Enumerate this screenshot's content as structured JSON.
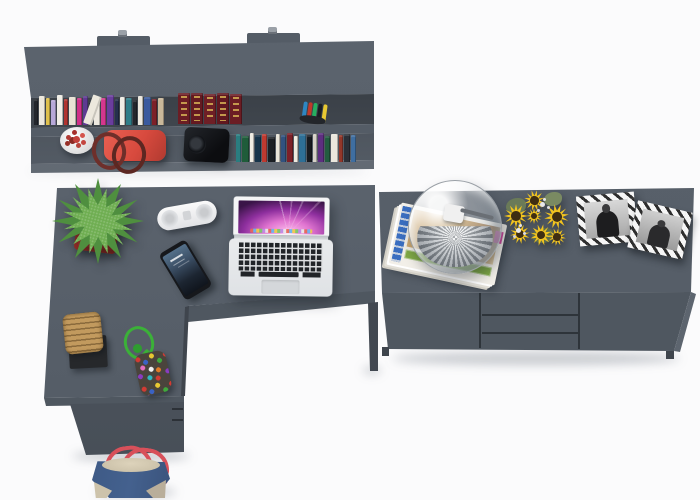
{
  "scene": {
    "kind": "3d-furniture-render-top-view",
    "room": "home office in grey",
    "furniture": [
      {
        "label": "wall shelf with two rows",
        "doors": 0
      },
      {
        "label": "L-shaped desk with drawer pedestal"
      },
      {
        "label": "sideboard",
        "doors": 2,
        "drawers": 3
      }
    ],
    "objects": [
      "books",
      "encyclopedia set",
      "pen cup",
      "white flower pot with red cactus",
      "red handbag",
      "black speaker",
      "potted green plant in red cube pot",
      "white pill speaker",
      "black smartphone",
      "open laptop with purple aurora wallpaper",
      "woven basket on black tray",
      "green cord keychain with beaded pouch",
      "denim tote bag with red straps",
      "glass dome lamp on magazine stack",
      "sunflower bouquet",
      "two black-and-white photo frames"
    ]
  },
  "colors": {
    "background": "#fbfbfc",
    "furniture_top": "#5c646e",
    "furniture_top_dark": "#545c66",
    "furniture_front": "#4f5760",
    "furniture_dark": "#3f454d",
    "shelf_opening": "#565d66",
    "pot_red": "#b5362d",
    "leaf_green": "#4f8f3f",
    "leaf_light": "#6fae52",
    "cord_green": "#3bb138",
    "sunflower_petal": "#f2c41f",
    "sunflower_center": "#3f2e12",
    "bag_denim": "#44618e",
    "bag_strap": "#d8505a",
    "bag_beige": "#cdc3ab",
    "basket_tan": "#c29a5e",
    "encyclopedia_maroon": "#6b1d24",
    "encyclopedia_gold": "#d4af54",
    "laptop_silver": "#e9ebed",
    "laptop_keys": "#212428",
    "wallpaper_pink": "#e074d0",
    "wallpaper_purple": "#8e2f9e",
    "wallpaper_dark": "#3a1448",
    "glass_rim": "#9aa0a6",
    "handbag_red": "#d84a3e",
    "bead_colors": [
      "#d23b33",
      "#3a62c4",
      "#e8c832",
      "#3fa93c",
      "#e46fc0",
      "#f0f0f0",
      "#e07b28",
      "#8a3bc0",
      "#30b8c0"
    ]
  },
  "shelf": {
    "books_upper": [
      {
        "c": "#23262c",
        "w": 4,
        "h": 26
      },
      {
        "c": "#ece7db",
        "w": 6,
        "h": 29
      },
      {
        "c": "#dfc04c",
        "w": 4,
        "h": 27
      },
      {
        "c": "#b7a8d8",
        "w": 5,
        "h": 25
      },
      {
        "c": "#f1eee6",
        "w": 6,
        "h": 30
      },
      {
        "c": "#b03430",
        "w": 4,
        "h": 26
      },
      {
        "c": "#e8e2d4",
        "w": 7,
        "h": 28
      },
      {
        "c": "#cf2f88",
        "w": 5,
        "h": 27
      },
      {
        "c": "#5d3a92",
        "w": 5,
        "h": 29
      },
      {
        "c": "#20262e",
        "w": 4,
        "h": 24
      },
      {
        "c": "#ede9e0",
        "w": 6,
        "h": 28
      },
      {
        "c": "#d4378e",
        "w": 5,
        "h": 27
      },
      {
        "c": "#6a3d9e",
        "w": 7,
        "h": 30
      },
      {
        "c": "#26304e",
        "w": 4,
        "h": 26
      },
      {
        "c": "#f0ede5",
        "w": 5,
        "h": 28
      },
      {
        "c": "#2f7d88",
        "w": 6,
        "h": 27
      },
      {
        "c": "#23262c",
        "w": 4,
        "h": 25
      },
      {
        "c": "#ece8de",
        "w": 5,
        "h": 29
      },
      {
        "c": "#3a5a9e",
        "w": 7,
        "h": 28
      },
      {
        "c": "#7c2028",
        "w": 5,
        "h": 26
      },
      {
        "c": "#c9b89a",
        "w": 6,
        "h": 27
      }
    ],
    "encyclopedia": [
      {
        "c": "#6b1d24",
        "w": 12,
        "h": 31
      },
      {
        "c": "#641a21",
        "w": 12,
        "h": 31
      },
      {
        "c": "#6e1f26",
        "w": 12,
        "h": 30
      },
      {
        "c": "#601820",
        "w": 12,
        "h": 31
      },
      {
        "c": "#6b1d24",
        "w": 12,
        "h": 30
      }
    ],
    "pens": [
      "#2e86c1",
      "#c0392b",
      "#27ae60",
      "#1b1e23",
      "#e8c832"
    ],
    "books_lower": [
      {
        "c": "#2a7d80",
        "w": 5,
        "h": 28
      },
      {
        "c": "#1f5c3a",
        "w": 7,
        "h": 26
      },
      {
        "c": "#efece3",
        "w": 4,
        "h": 29
      },
      {
        "c": "#17344a",
        "w": 6,
        "h": 27
      },
      {
        "c": "#bf3a30",
        "w": 5,
        "h": 28
      },
      {
        "c": "#1b1f24",
        "w": 7,
        "h": 25
      },
      {
        "c": "#e9e5da",
        "w": 4,
        "h": 28
      },
      {
        "c": "#31527f",
        "w": 5,
        "h": 27
      },
      {
        "c": "#7c2028",
        "w": 6,
        "h": 29
      },
      {
        "c": "#efeadf",
        "w": 4,
        "h": 26
      },
      {
        "c": "#2e6f96",
        "w": 7,
        "h": 28
      },
      {
        "c": "#181b20",
        "w": 5,
        "h": 27
      },
      {
        "c": "#d6d2c8",
        "w": 4,
        "h": 28
      },
      {
        "c": "#5d2f80",
        "w": 6,
        "h": 29
      },
      {
        "c": "#235c40",
        "w": 5,
        "h": 26
      },
      {
        "c": "#ebe7dd",
        "w": 7,
        "h": 28
      },
      {
        "c": "#93372a",
        "w": 4,
        "h": 27
      },
      {
        "c": "#2b3038",
        "w": 6,
        "h": 28
      },
      {
        "c": "#3f6ea0",
        "w": 5,
        "h": 27
      }
    ]
  }
}
